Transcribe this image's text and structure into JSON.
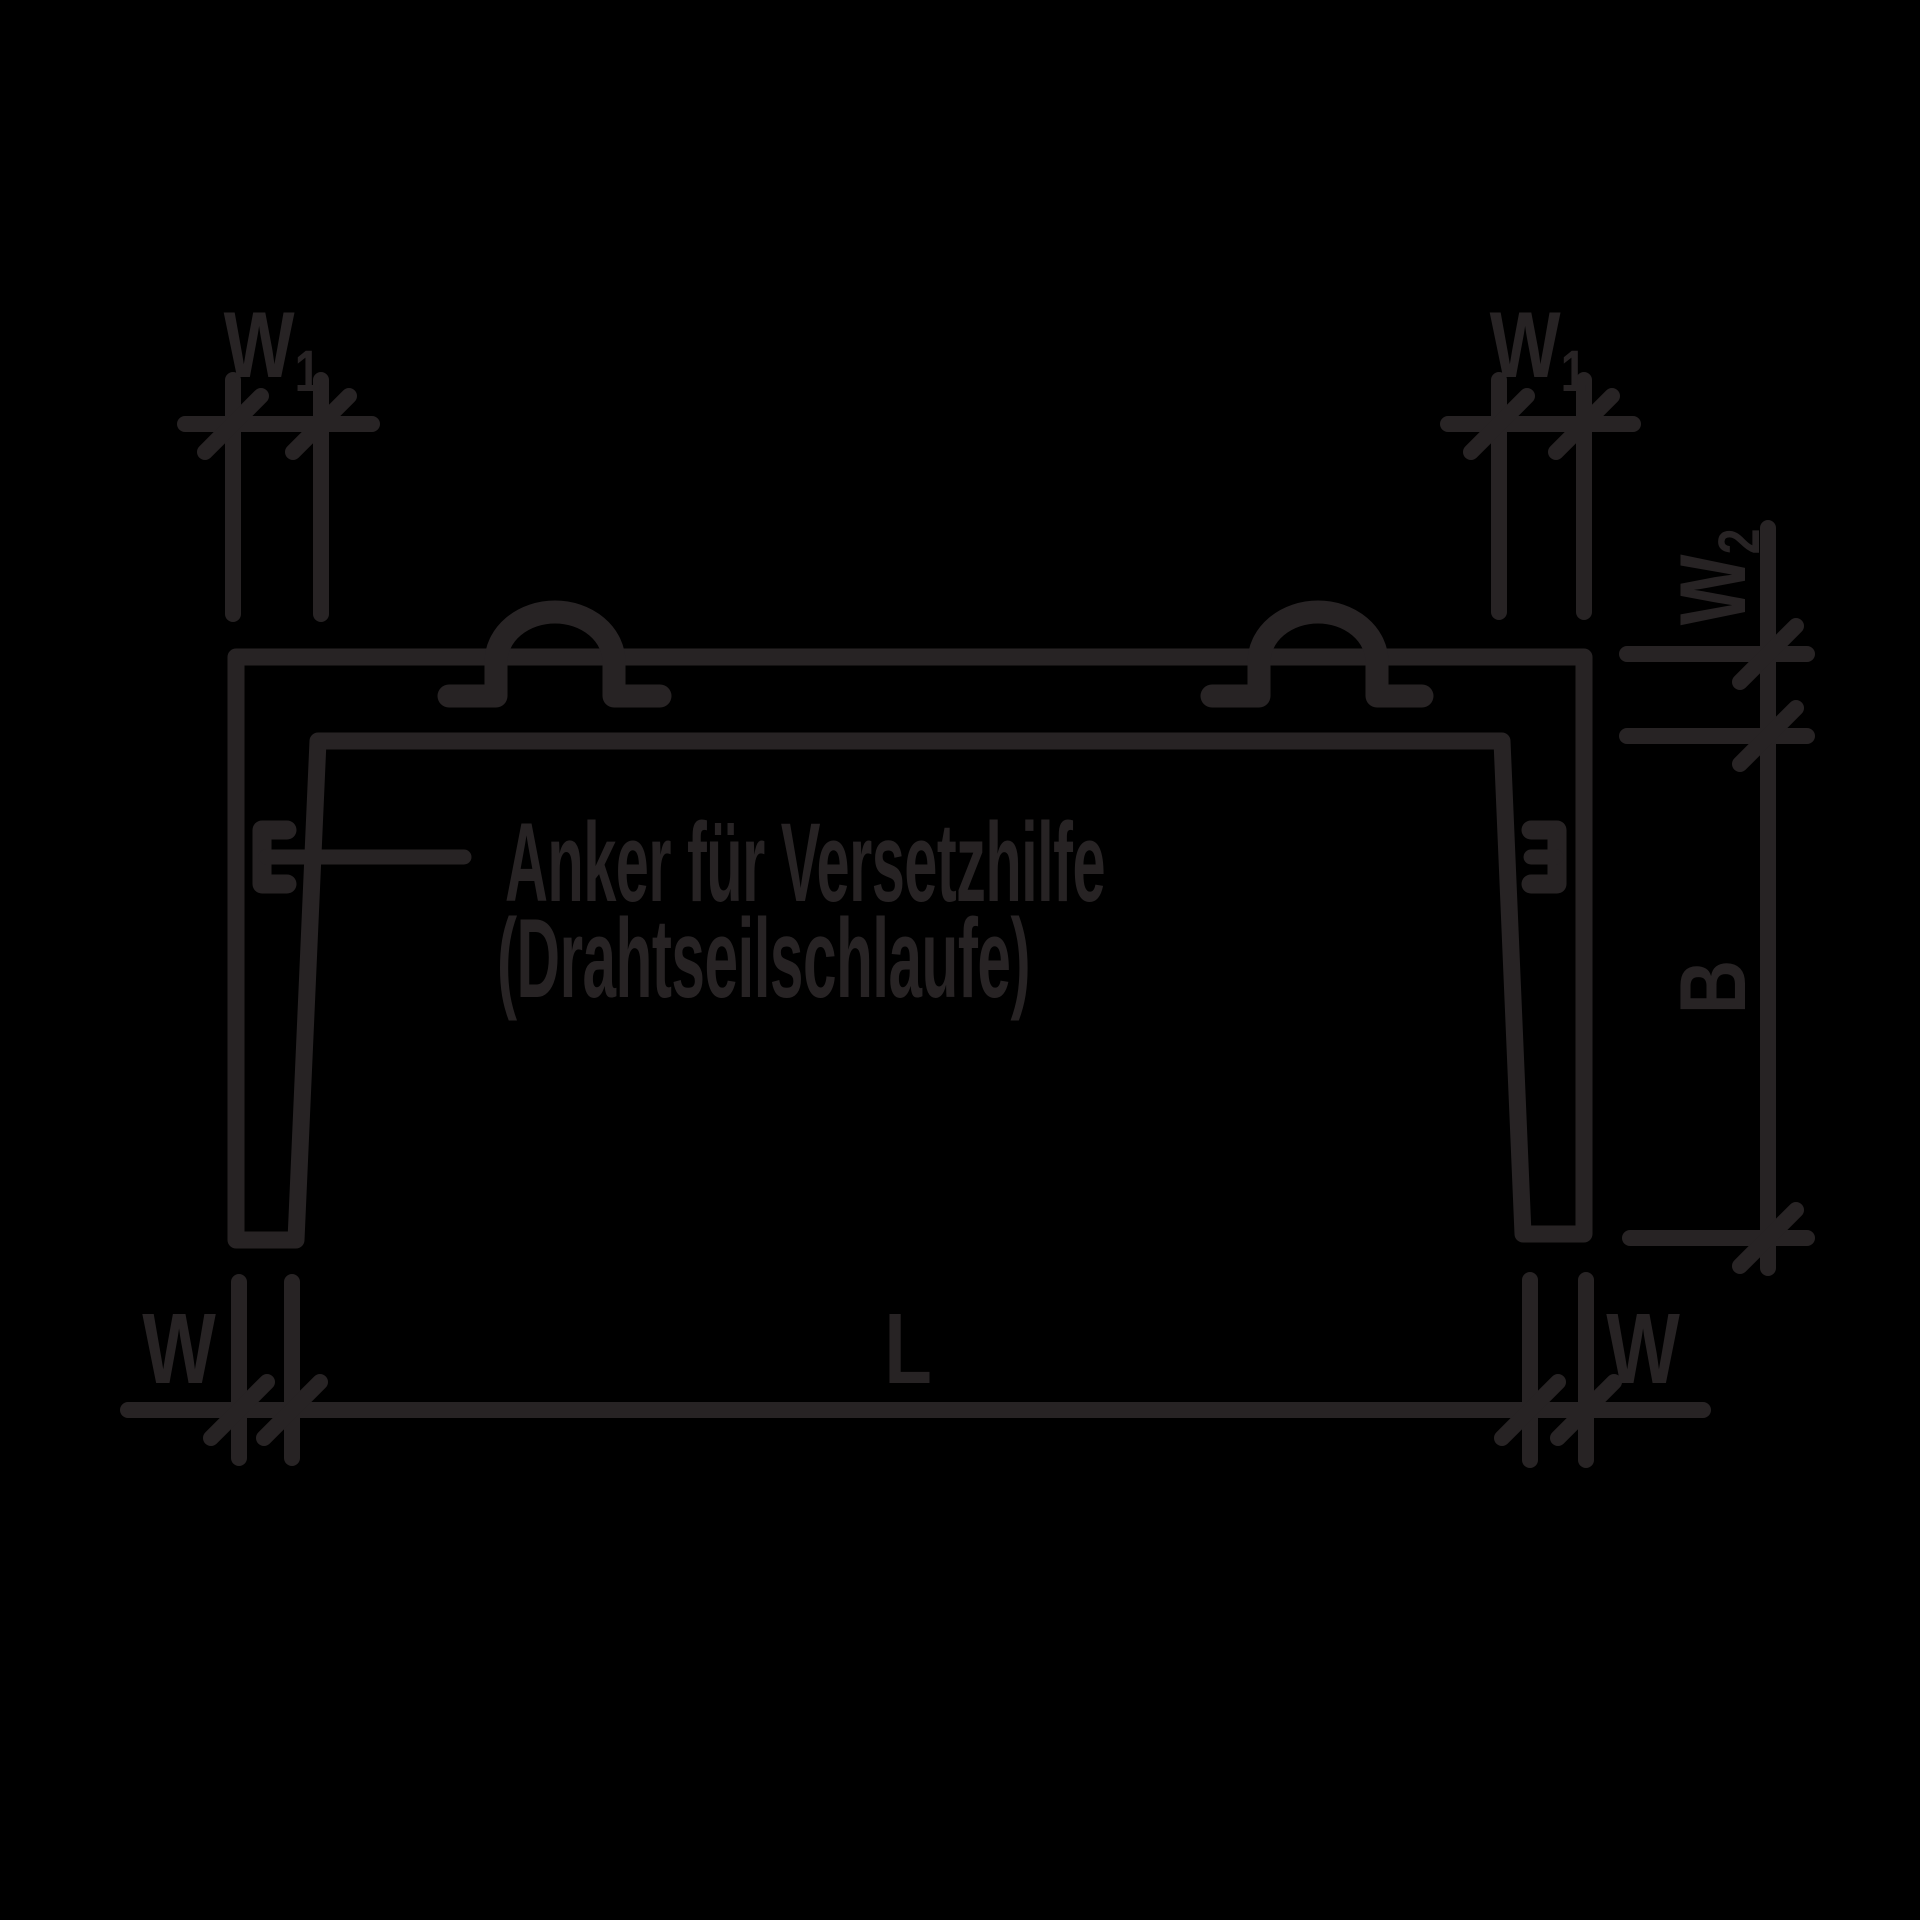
{
  "canvas": {
    "background": "#000000",
    "line_color": "#272324"
  },
  "annotation": {
    "line1": "Anker für Versetzhilfe",
    "line2": "(Drahtseilschlaufe)"
  },
  "dims": {
    "w1_left": {
      "base": "W",
      "sub": "1"
    },
    "w1_right": {
      "base": "W",
      "sub": "1"
    },
    "w2": {
      "base": "W",
      "sub": "2"
    },
    "b": "B",
    "w_bottom_left": "W",
    "l_bottom": "L",
    "w_bottom_right": "W"
  }
}
